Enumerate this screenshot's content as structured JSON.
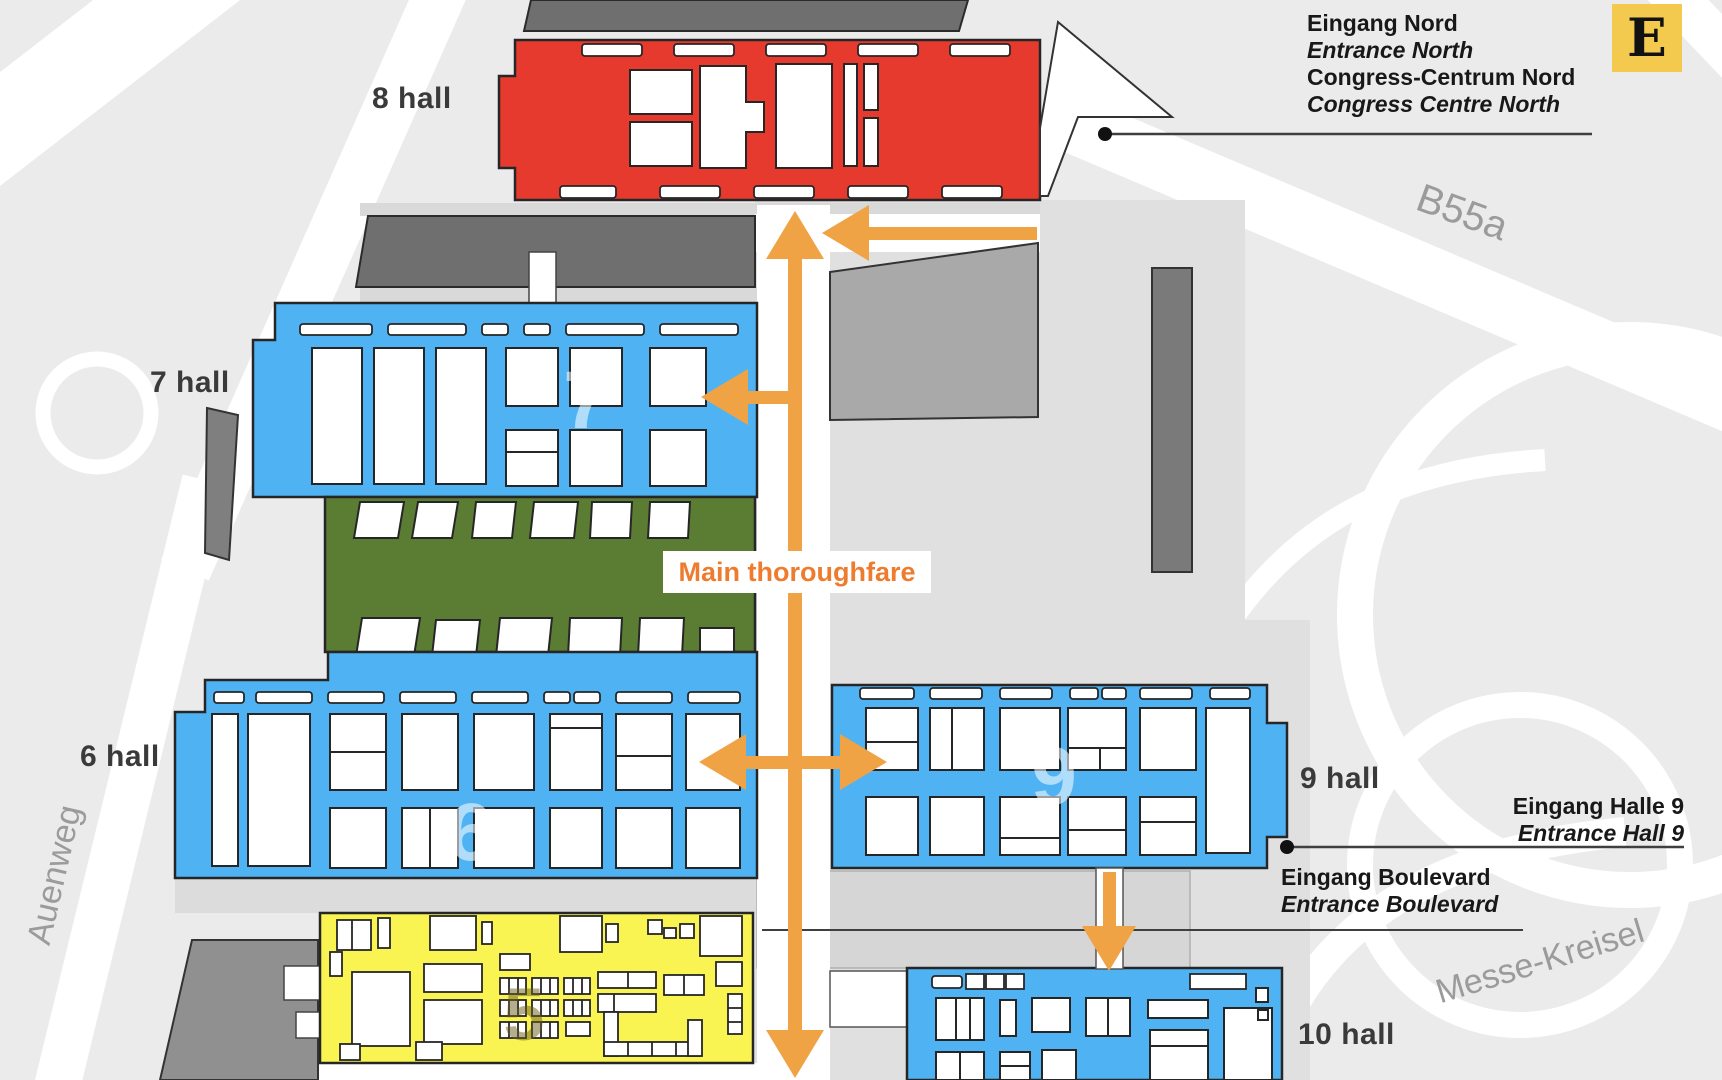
{
  "map": {
    "hall_labels": {
      "hall8": "8 hall",
      "hall7": "7 hall",
      "hall6": "6 hall",
      "hall9": "9 hall",
      "hall10": "10 hall"
    },
    "hall_watermarks": {
      "hall7": "7",
      "hall6": "6",
      "hall9": "9",
      "hall5": "5"
    },
    "thoroughfare_label": "Main thoroughfare",
    "entrance_north": {
      "line1": "Eingang Nord",
      "line2": "Entrance North",
      "line3": "Congress-Centrum Nord",
      "line4": "Congress Centre North"
    },
    "entrance_hall9": {
      "line1": "Eingang Halle 9",
      "line2": "Entrance Hall 9"
    },
    "entrance_boulevard": {
      "line1": "Eingang Boulevard",
      "line2": "Entrance Boulevard"
    },
    "roads": {
      "auenweg": "Auenweg",
      "b55a": "B55a",
      "messe_kreisel": "Messe-Kreisel"
    },
    "legend_logo": "E",
    "colors": {
      "hall_blue": "#4fb3f3",
      "hall_red": "#e63a2e",
      "hall_green": "#5b7d33",
      "hall_yellow": "#f9f452",
      "accent_orange": "#f0a344",
      "thoroughfare_text": "#ed7c2e",
      "logo_gold": "#f3c94e",
      "road_label_gray": "#9b9b9b"
    }
  }
}
